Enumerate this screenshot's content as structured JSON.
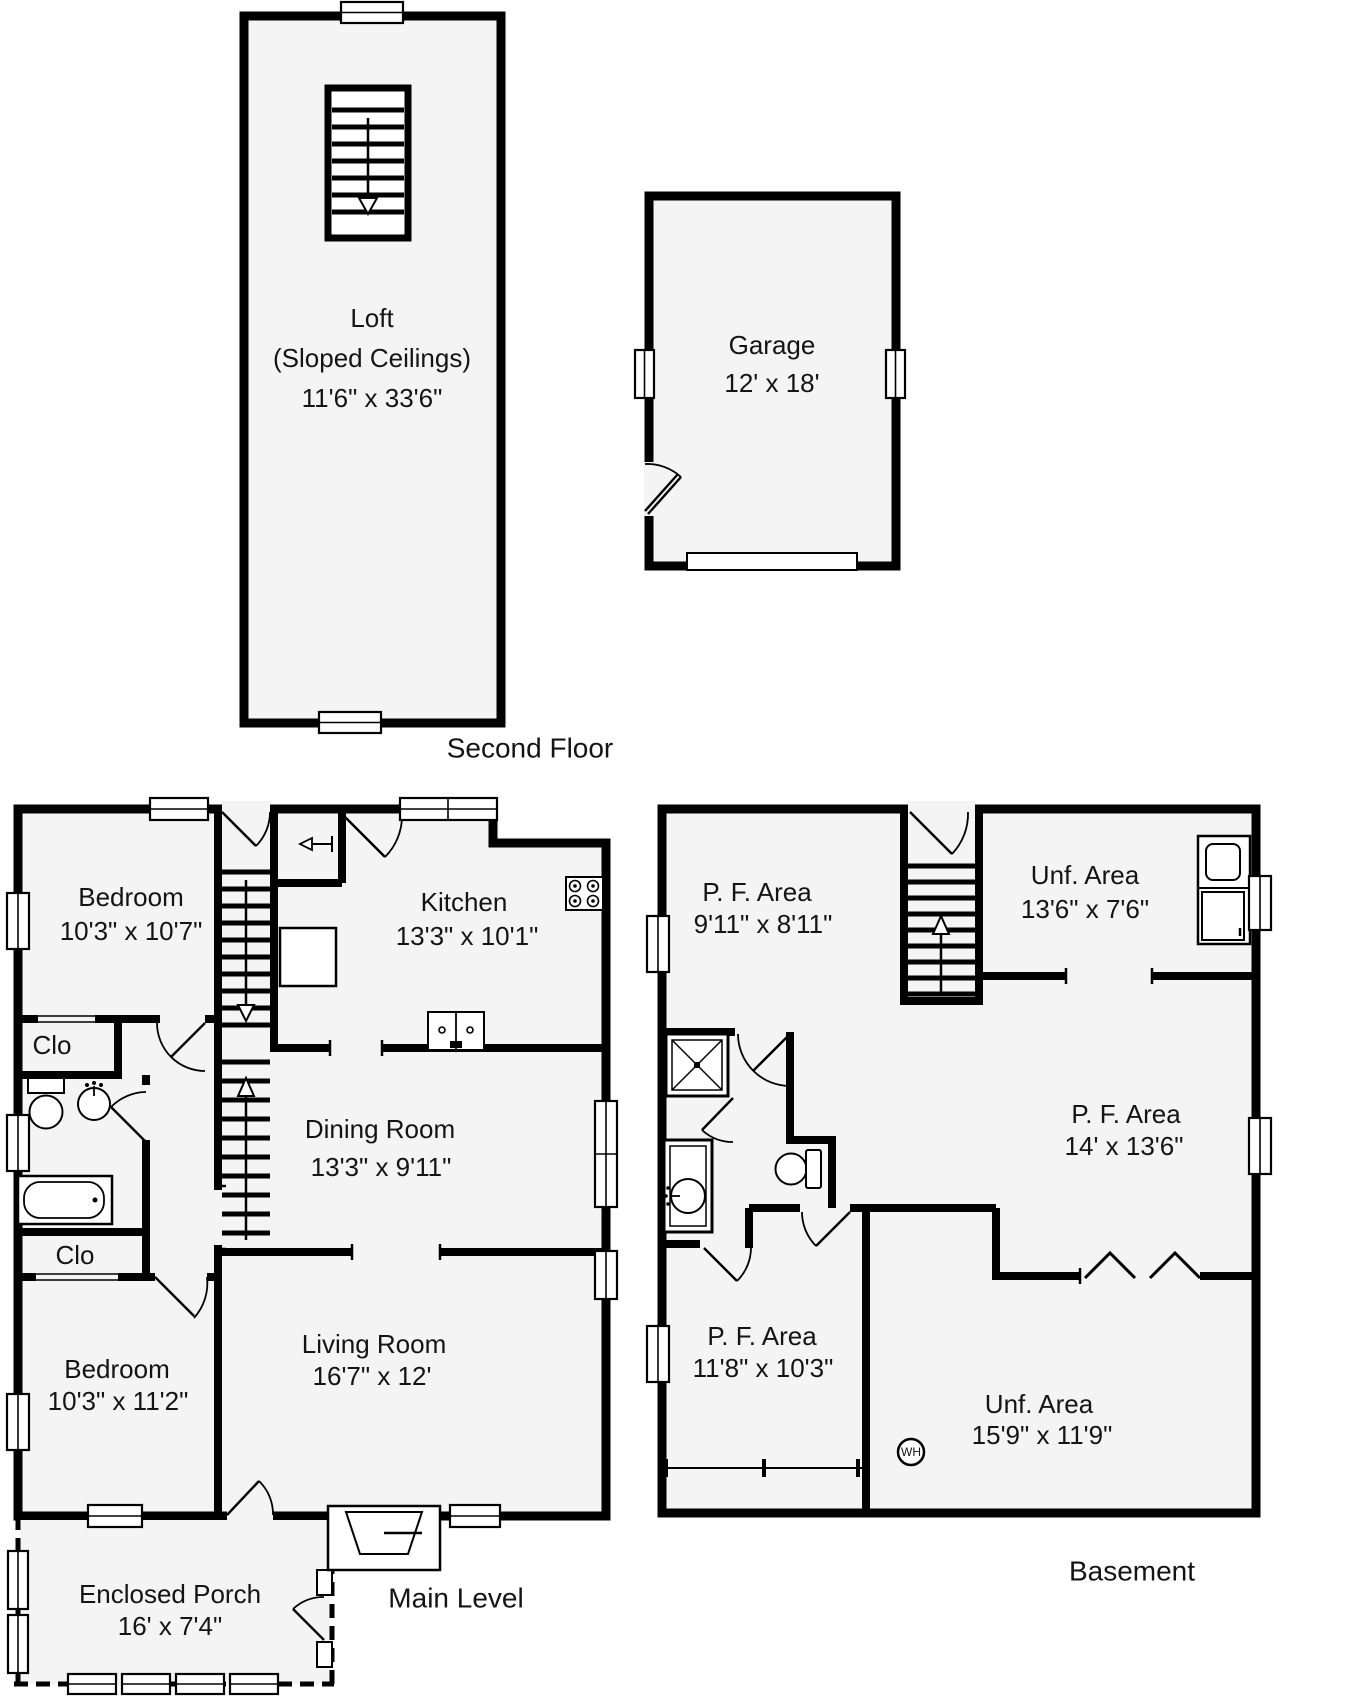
{
  "floors": {
    "second_floor": {
      "label": "Second Floor",
      "rooms": {
        "loft": {
          "name": "Loft",
          "note": "(Sloped Ceilings)",
          "dims": "11'6\" x 33'6\""
        }
      }
    },
    "garage_building": {
      "rooms": {
        "garage": {
          "name": "Garage",
          "dims": "12' x 18'"
        }
      }
    },
    "main_level": {
      "label": "Main Level",
      "rooms": {
        "bedroom_upper": {
          "name": "Bedroom",
          "dims": "10'3\" x 10'7\""
        },
        "kitchen": {
          "name": "Kitchen",
          "dims": "13'3\" x 10'1\""
        },
        "closet_upper": {
          "name": "Clo"
        },
        "dining_room": {
          "name": "Dining Room",
          "dims": "13'3\" x 9'11\""
        },
        "closet_lower": {
          "name": "Clo"
        },
        "bedroom_lower": {
          "name": "Bedroom",
          "dims": "10'3\" x 11'2\""
        },
        "living_room": {
          "name": "Living Room",
          "dims": "16'7\" x 12'"
        },
        "enclosed_porch": {
          "name": "Enclosed Porch",
          "dims": "16' x 7'4\""
        }
      }
    },
    "basement": {
      "label": "Basement",
      "rooms": {
        "pf_area_upper": {
          "name": "P. F. Area",
          "dims": "9'11\" x 8'11\""
        },
        "unf_area_upper": {
          "name": "Unf. Area",
          "dims": "13'6\" x 7'6\""
        },
        "pf_area_mid": {
          "name": "P. F. Area",
          "dims": "14' x 13'6\""
        },
        "pf_area_lower": {
          "name": "P. F. Area",
          "dims": "11'8\" x 10'3\""
        },
        "unf_area_lower": {
          "name": "Unf. Area",
          "dims": "15'9\" x 11'9\""
        },
        "water_heater": {
          "label": "WH"
        }
      }
    }
  },
  "colors": {
    "wall": "#000000",
    "floor_fill": "#f4f4f4",
    "background": "#ffffff"
  }
}
